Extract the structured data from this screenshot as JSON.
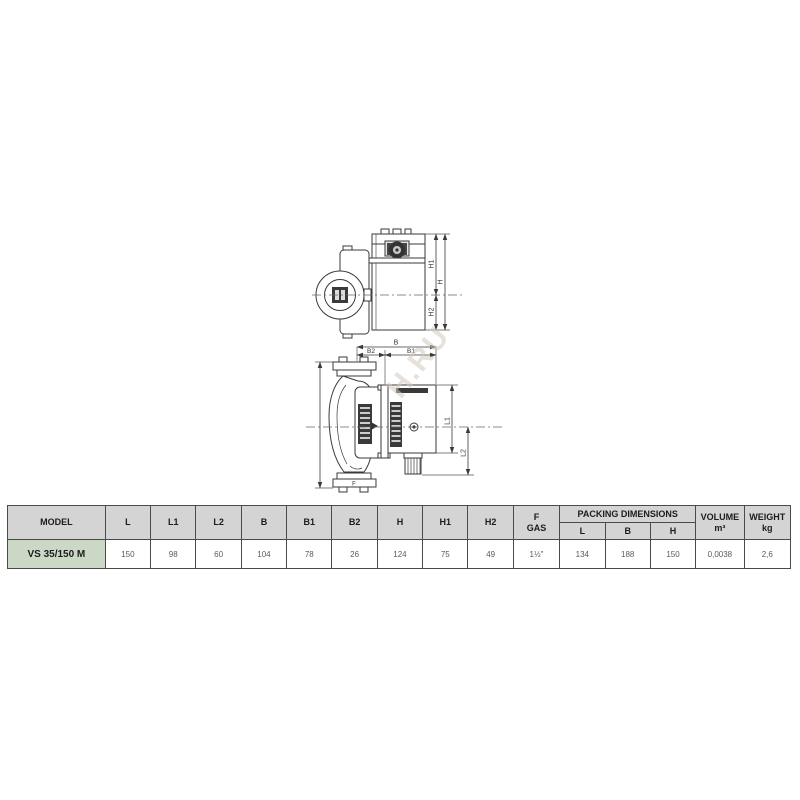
{
  "drawing": {
    "watermark": "H.RU",
    "top_view_labels": {
      "h1": "H1",
      "h2": "H2",
      "h": "H"
    },
    "front_view_labels": {
      "b": "B",
      "b1": "B1",
      "b2": "B2",
      "l1": "L1",
      "l2": "L2",
      "f": "F"
    }
  },
  "table": {
    "headers": {
      "model": "MODEL",
      "dims": [
        "L",
        "L1",
        "L2",
        "B",
        "B1",
        "B2",
        "H",
        "H1",
        "H2"
      ],
      "f_gas": [
        "F",
        "GAS"
      ],
      "packing": {
        "title": "PACKING DIMENSIONS",
        "cols": [
          "L",
          "B",
          "H"
        ]
      },
      "volume": [
        "VOLUME",
        "m³"
      ],
      "weight": [
        "WEIGHT",
        "kg"
      ]
    },
    "row": {
      "model": "VS 35/150 M",
      "values": [
        "150",
        "98",
        "60",
        "104",
        "78",
        "26",
        "124",
        "75",
        "49",
        "1½\"",
        "134",
        "188",
        "150",
        "0,0038",
        "2,6"
      ]
    }
  },
  "colors": {
    "line": "#3a3a3a",
    "header_bg": "#d4d4d4",
    "model_bg": "#ccd8c6",
    "watermark": "#d4cabe"
  }
}
